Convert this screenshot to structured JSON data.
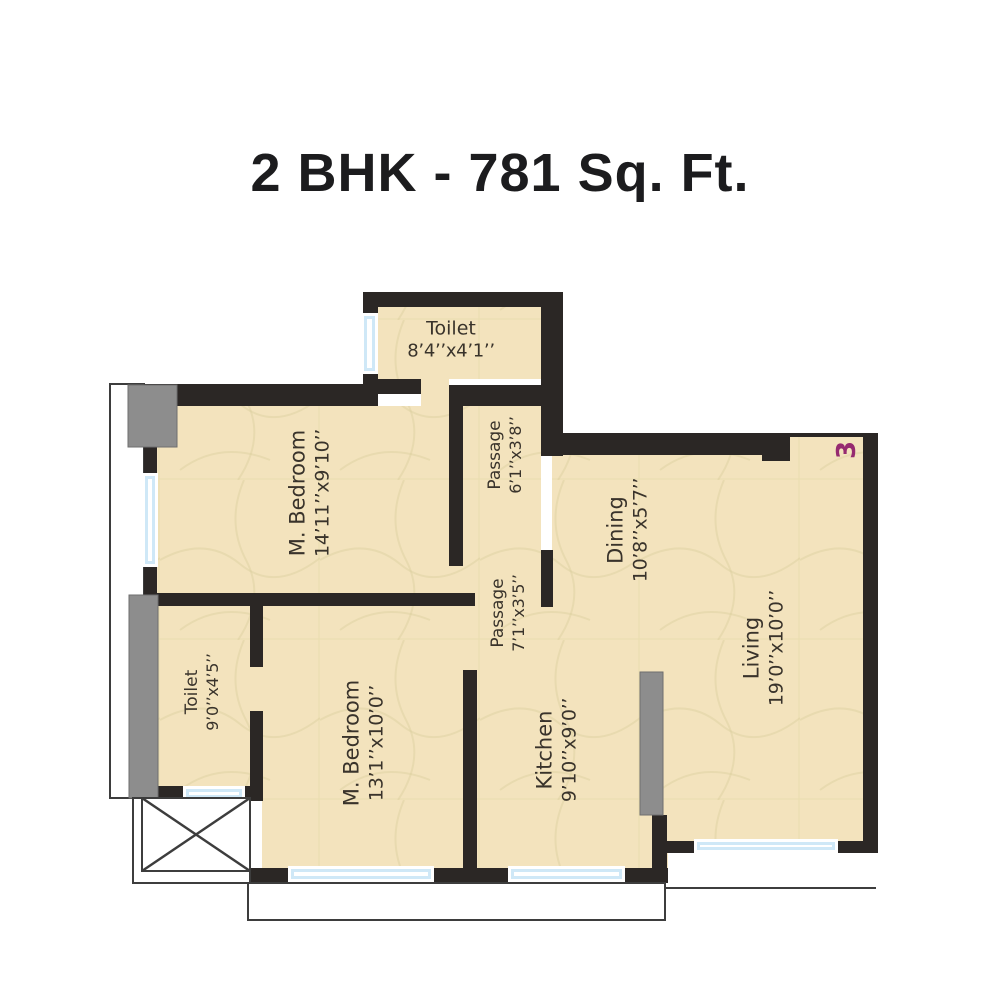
{
  "title": "2 BHK - 781 Sq. Ft.",
  "unit_number": "3",
  "plan_type": "floor-plan",
  "colors": {
    "wall": "#2b2725",
    "floor": "#f3e3bd",
    "floor_line": "#ddcf9d",
    "balcony_gray": "#8d8d8d",
    "window_blue": "#cfe8f7",
    "label_text": "#39332b",
    "unit_number_color": "#962a70",
    "title_color": "#1c1c1e"
  },
  "rooms": [
    {
      "id": "toilet-top",
      "name": "Toilet",
      "dims": "8’4’’x4’1’’"
    },
    {
      "id": "m-bedroom-top",
      "name": "M. Bedroom",
      "dims": "14’11’’x9’10’’"
    },
    {
      "id": "passage-top",
      "name": "Passage",
      "dims": "6’1’’x3’8’’"
    },
    {
      "id": "dining",
      "name": "Dining",
      "dims": "10’8’’x5’7’’"
    },
    {
      "id": "living",
      "name": "Living",
      "dims": "19’0’’x10’0’’"
    },
    {
      "id": "passage-lower",
      "name": "Passage",
      "dims": "7’1’’x3’5’’"
    },
    {
      "id": "toilet-left",
      "name": "Toilet",
      "dims": "9’0’’x4’5’’"
    },
    {
      "id": "m-bedroom-bottom",
      "name": "M. Bedroom",
      "dims": "13’1’’x10’0’’"
    },
    {
      "id": "kitchen",
      "name": "Kitchen",
      "dims": "9’10’’x9’0’’"
    }
  ]
}
